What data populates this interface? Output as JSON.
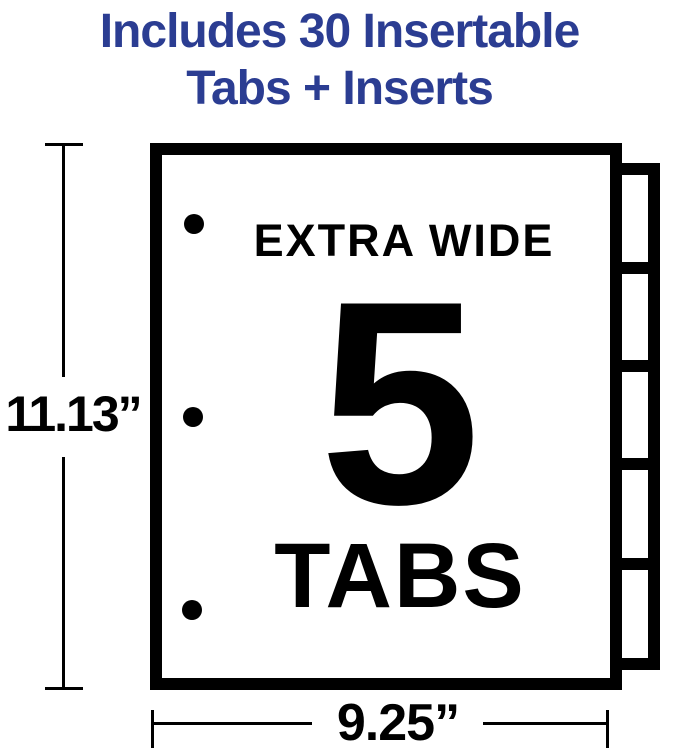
{
  "title": {
    "line1": "Includes 30 Insertable",
    "line2": "Tabs + Inserts"
  },
  "sheet": {
    "label_top": "EXTRA WIDE",
    "tab_count": "5",
    "label_bottom": "TABS",
    "tabs_visible": 5,
    "hole_punches_visible": 3
  },
  "dimensions": {
    "height_label": "11.13”",
    "width_label": "9.25”"
  },
  "colors": {
    "accent_blue": "#2B3D92",
    "ink": "#000000",
    "background": "#FFFFFF"
  }
}
